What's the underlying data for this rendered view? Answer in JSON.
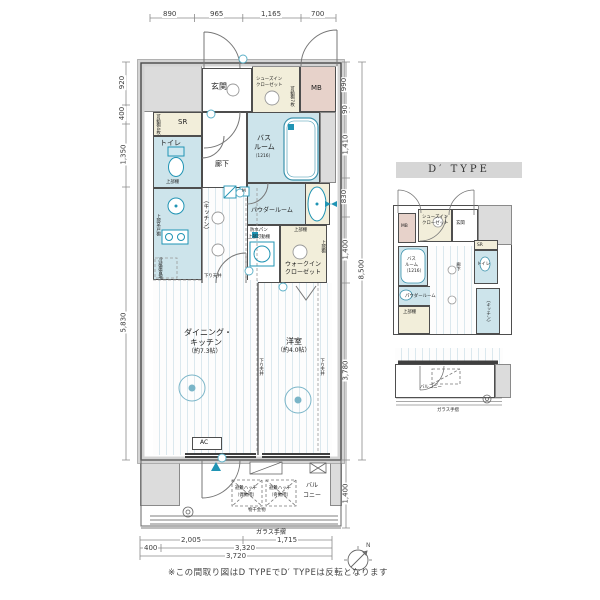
{
  "note": "※この間取り図はD TYPEでD′ TYPEは反転となります",
  "colors": {
    "wet_area": "#cde4eb",
    "closet": "#f2eeda",
    "meter_box": "#e7d2ca",
    "wall_gray": "#dcdcdc",
    "accent_teal": "#2094b4"
  },
  "rooms": {
    "genkan": "玄関",
    "sic1": "シューズイン",
    "sic2": "クローゼット",
    "sic_shelf": "可動棚7枚",
    "mb": "MB",
    "sr": "SR",
    "sr_shelf": "可動棚4枚",
    "toilet": "トイレ",
    "toilet_shelf": "上部棚",
    "hall": "廊下",
    "bath1": "バス",
    "bath2": "ルーム",
    "bath3": "（1216）",
    "powder": "パウダールーム",
    "m": "M",
    "kitchen": "（キッチン）",
    "cupboard": "上部吊戸棚",
    "fridge": "冷蔵庫置場",
    "pan": "防水パン",
    "pan_shelf": "上部可動棚",
    "wic_top": "上部棚",
    "wic1": "ウォークイン",
    "wic2": "クローゼット",
    "wic_side": "上部棚",
    "dk1": "ダイニング・",
    "dk2": "キッチン",
    "dk3": "（約7.3帖）",
    "west1": "洋室",
    "west2": "（約4.0帖）",
    "ac": "AC",
    "sagari": "下り天井",
    "bal1": "バル",
    "bal2": "コニー",
    "hatch1a": "避難ハッチ",
    "hatch1b": "（偶数階）",
    "hatch2a": "避難ハッチ",
    "hatch2b": "（奇数階）",
    "pole": "物干金物",
    "glass": "ガラス手摺"
  },
  "dims": {
    "top": [
      "890",
      "965",
      "1,165",
      "700"
    ],
    "left": [
      "920",
      "400",
      "1,350",
      "5,830"
    ],
    "right": [
      "990",
      "90",
      "1,410",
      "830",
      "1,400",
      "3,780"
    ],
    "total": "8,500",
    "balcony": "1,400",
    "b1": [
      "2,005",
      "1,715"
    ],
    "b2": [
      "400",
      "3,320"
    ],
    "b3": "3,720"
  },
  "compass": {
    "n": "N"
  },
  "mini": {
    "header": "D′ TYPE",
    "mb": "MB",
    "sic1": "シューズイン",
    "sic2": "クローゼット",
    "genkan": "玄関",
    "bath1": "バス",
    "bath2": "ルーム",
    "bath3": "（1216）",
    "toilet": "トイレ",
    "sr": "SR",
    "powder": "パウダールーム",
    "hall": "廊下",
    "shelf": "上部棚",
    "kitchen": "（キッチン）",
    "balcony": "バルコニー",
    "glass": "ガラス手摺"
  }
}
